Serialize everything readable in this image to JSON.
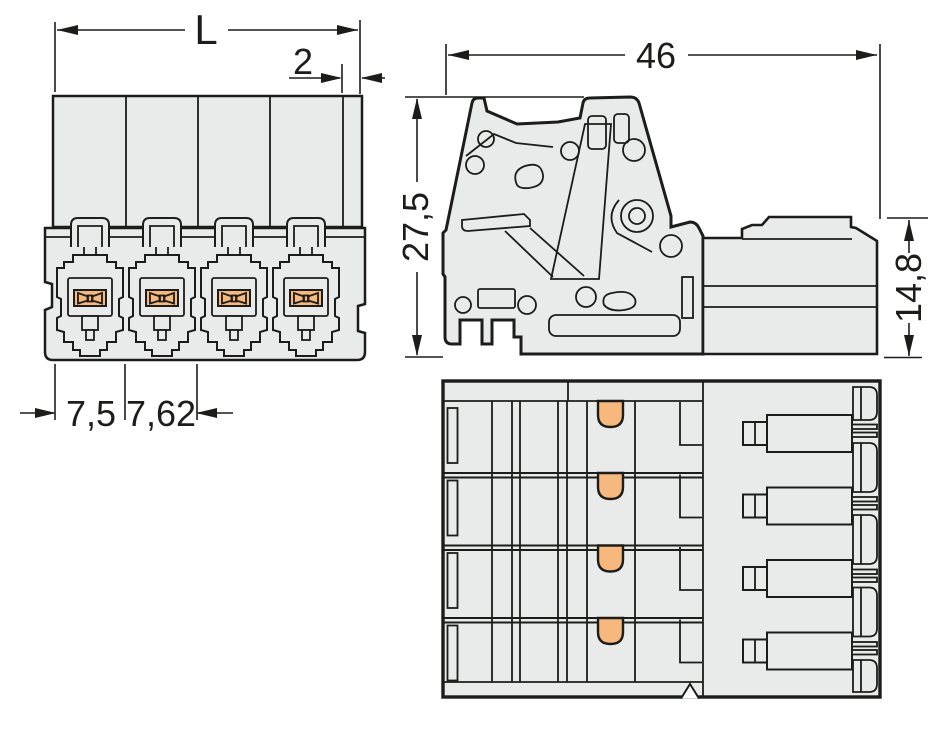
{
  "drawing": {
    "product": "pluggable-connector-4-pole",
    "poles": 4,
    "dimensions": {
      "overall_length": "L",
      "end_offset": "2",
      "depth": "46",
      "height": "27,5",
      "plug_height": "14,8",
      "first_pitch": "7,5",
      "pole_pitch": "7,62"
    },
    "colors": {
      "body": "#e9eaea",
      "line": "#1c1c1a",
      "contact": "#f7b87e",
      "background": "#ffffff"
    }
  }
}
